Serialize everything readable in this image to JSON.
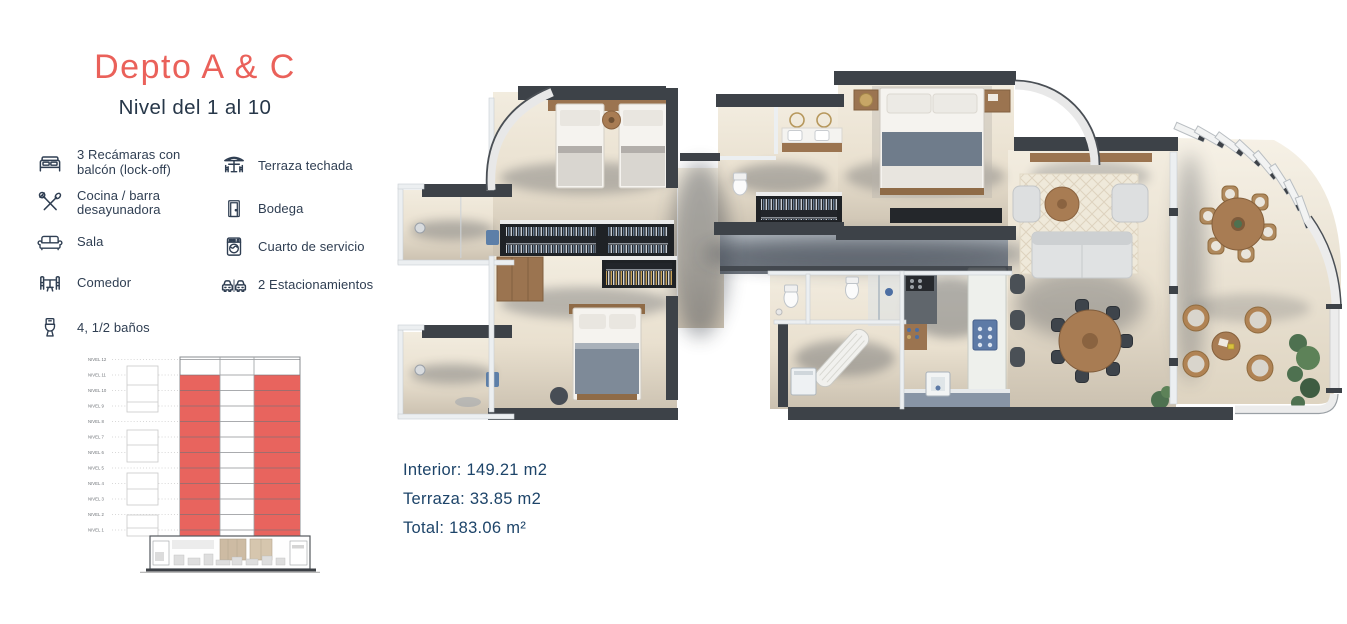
{
  "header": {
    "title": "Depto A & C",
    "subtitle": "Nivel del 1 al 10"
  },
  "features": {
    "column1": [
      {
        "icon": "bed-icon",
        "label": "3 Recámaras con balcón (lock-off)"
      },
      {
        "icon": "kitchen-icon",
        "label": "Cocina / barra desayunadora"
      },
      {
        "icon": "sofa-icon",
        "label": "Sala"
      },
      {
        "icon": "dining-icon",
        "label": "Comedor"
      },
      {
        "icon": "toilet-icon",
        "label": "4, 1/2 baños"
      }
    ],
    "column2": [
      {
        "icon": "terrace-icon",
        "label": "Terraza techada"
      },
      {
        "icon": "door-icon",
        "label": "Bodega"
      },
      {
        "icon": "washer-icon",
        "label": "Cuarto de servicio"
      },
      {
        "icon": "cars-icon",
        "label": "2 Estacionamientos"
      }
    ]
  },
  "elevation": {
    "levels": [
      "NIVEL 12",
      "NIVEL 11",
      "NIVEL 10",
      "NIVEL 9",
      "NIVEL 8",
      "NIVEL 7",
      "NIVEL 6",
      "NIVEL 5",
      "NIVEL 4",
      "NIVEL 3",
      "NIVEL 2",
      "NIVEL 1"
    ],
    "highlighted_levels": "NIVEL 1 a NIVEL 10",
    "highlight_color": "#e8645e"
  },
  "areas": {
    "interior": "Interior: 149.21 m2",
    "terrace": "Terraza: 33.85 m2",
    "total": "Total: 183.06 m²"
  },
  "colors": {
    "accent": "#ea615a",
    "navy_text": "#2f3e52",
    "subtitle_text": "#273749",
    "area_text": "#1d4469",
    "highlight_red": "#e8645e",
    "wall_dark": "#3d4248",
    "floor_cream": "#ece3d2"
  }
}
